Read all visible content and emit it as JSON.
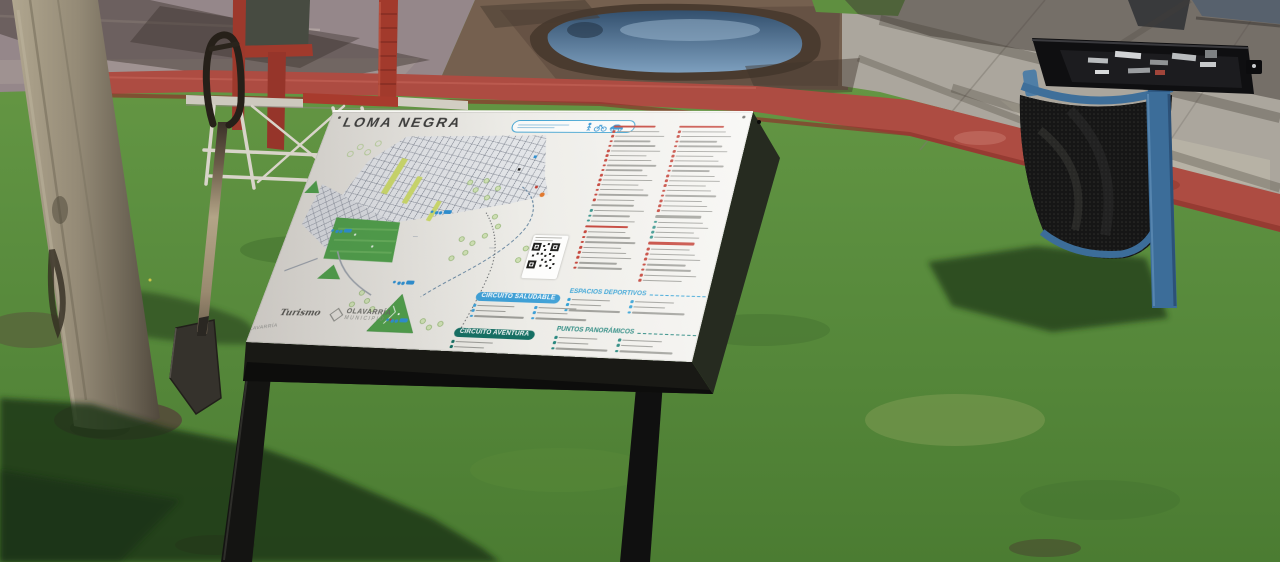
{
  "scene": {
    "setting": "sunny park lawn beside a street",
    "objects": [
      {
        "name": "tourist-map-sign",
        "description": "white lectern-style information board on two black metal legs",
        "title_on_sign": "LOMA NEGRA"
      },
      {
        "name": "tree-trunk",
        "color": "#948a76"
      },
      {
        "name": "shovel",
        "description": "spade stuck upright in the lawn, dark D-grip handle, light shaft",
        "colors": [
          "#2a241c",
          "#b3a487"
        ]
      },
      {
        "name": "metal-frame",
        "description": "galvanized tube frame standing on the grass",
        "color": "#d5d1c6"
      },
      {
        "name": "red-post-structure",
        "description": "weathered red posts with dark panel near the road",
        "color": "#9d392c"
      },
      {
        "name": "red-painted-curb",
        "color": "#ad4c42"
      },
      {
        "name": "asphalt-road",
        "color": "#95878a"
      },
      {
        "name": "dirt-shoulder-with-puddle",
        "puddle_color": "#54718e"
      },
      {
        "name": "concrete-sidewalk",
        "color": "#aba69d"
      },
      {
        "name": "trash-can",
        "description": "blue frame with black mesh basket",
        "frame_color": "#3c6d99"
      },
      {
        "name": "toolbox",
        "description": "open black tool case with silver tools resting on the trash can",
        "color": "#121214"
      },
      {
        "name": "lawn",
        "color": "#5d9040"
      },
      {
        "name": "shadows",
        "description": "tree, signboard and trash-can shadows cast on the grass"
      }
    ]
  },
  "sign": {
    "title": "LOMA NEGRA",
    "board_face_color": "#ebe9e4",
    "top_banner": {
      "legible": false,
      "border_color": "#3aa0d0",
      "icons": [
        "pedestrian-icon",
        "bike-icon",
        "car-icon"
      ]
    },
    "map": {
      "features": [
        "street-grid",
        "green-park-blocks",
        "yellow-green-boulevard-strips",
        "hill-symbols",
        "tree-symbols",
        "dashed-circuit-routes",
        "walk-bike-car-icon-clusters",
        "you-are-here-marker"
      ],
      "qr_code": true,
      "edge_label": "OLAVARRÍA",
      "park_color": "#4f9e49",
      "route_color": "#5b7d9a"
    },
    "legend": {
      "note": "point-of-interest list text too small to read in photo",
      "columns": [
        {
          "groups": [
            {
              "heading": "",
              "heading_color": "#c13a2f",
              "marker_color": "#c13a2f",
              "items": 15
            },
            {
              "heading": "",
              "heading_color": "#9a9a94",
              "marker_color": "#2e8f86",
              "items": 3
            },
            {
              "heading": "",
              "heading_color": "#c13a2f",
              "marker_color": "#c13a2f",
              "items": 8
            }
          ]
        },
        {
          "groups": [
            {
              "heading": "",
              "heading_color": "#c13a2f",
              "marker_color": "#c13a2f",
              "items": 17
            },
            {
              "heading": "",
              "heading_color": "#9a9a94",
              "marker_color": "#2e8f86",
              "items": 4
            },
            {
              "heading": "",
              "heading_color": "#c13a2f",
              "marker_color": "#c13a2f",
              "items": 7
            }
          ]
        }
      ]
    },
    "circuits": {
      "saludable": {
        "label": "CIRCUITO SALUDABLE",
        "color": "#3fa0d6",
        "item_cols": [
          3,
          3
        ]
      },
      "deportivos": {
        "label": "ESPACIOS DEPORTIVOS",
        "color": "#2f9fd4",
        "item_cols": [
          3,
          3
        ]
      },
      "aventura": {
        "label": "CIRCUITO AVENTURA",
        "color": "#156f63",
        "item_cols": [
          3
        ]
      },
      "panoramicos": {
        "label": "PUNTOS PANORÁMICOS",
        "color": "#23857c",
        "item_cols": [
          3,
          3
        ]
      }
    },
    "logos": {
      "turismo": "Turismo",
      "municipio": "OLAVARRÍA",
      "municipio_sub": "MUNICIPIO"
    }
  }
}
